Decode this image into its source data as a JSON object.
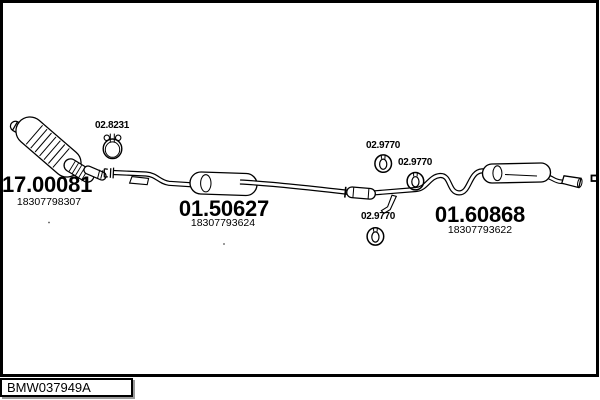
{
  "diagram": {
    "type": "exhaust-system-parts-diagram",
    "background": "#ffffff",
    "line_color": "#000000",
    "parts": {
      "clamp": {
        "code": "02.8231"
      },
      "catalytic_converter": {
        "code": "17.00081",
        "part_number": "18307798307"
      },
      "middle_muffler": {
        "code": "01.50627",
        "part_number": "18307793624"
      },
      "rear_muffler": {
        "code": "01.60868",
        "part_number": "18307793622"
      },
      "hanger_1": {
        "code": "02.9770"
      },
      "hanger_2": {
        "code": "02.9770"
      },
      "hanger_3": {
        "code": "02.9770"
      }
    }
  },
  "plate": {
    "id": "BMW037949A",
    "shadow_color": "#9a9a9a"
  }
}
